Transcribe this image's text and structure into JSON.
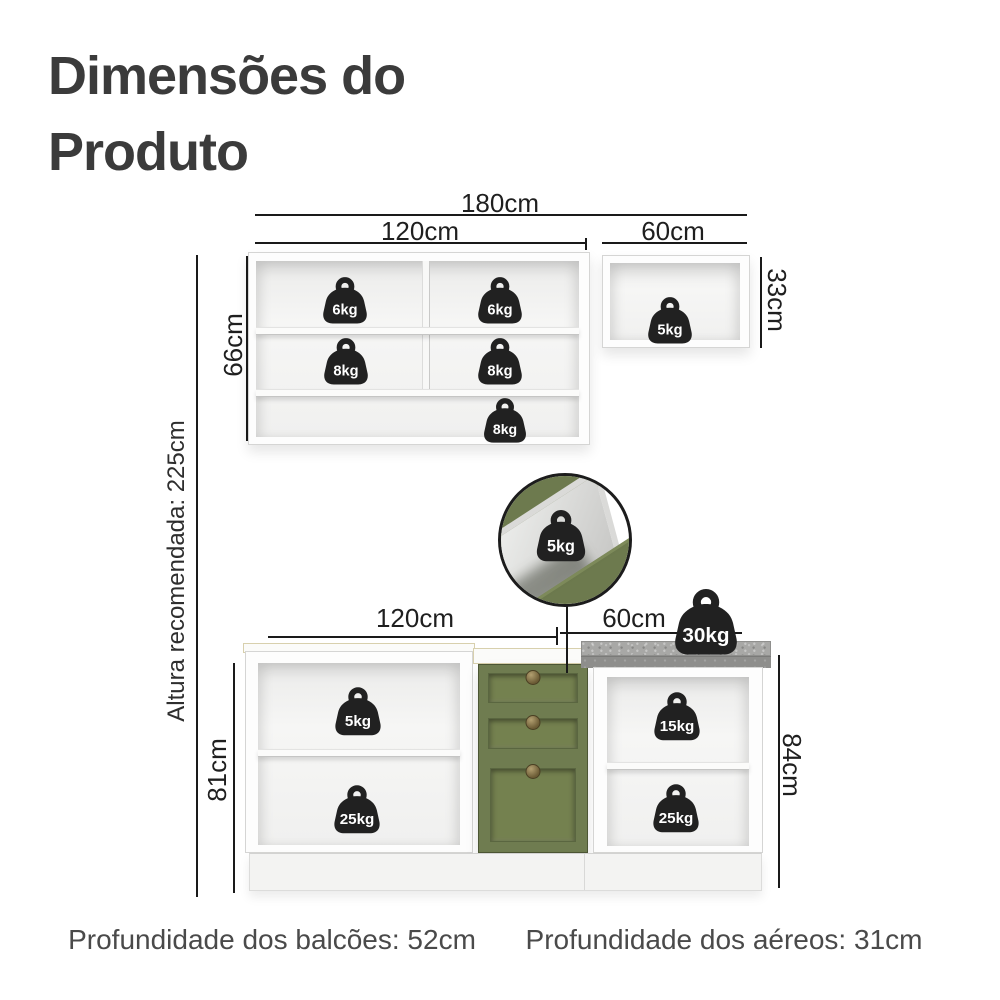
{
  "page": {
    "title": "Dimensões do Produto"
  },
  "colors": {
    "accent_green": "#6F7C50",
    "countertop_gray": "#A8A8A6",
    "badge_black": "#212121",
    "dimension_line": "#1A1A1A",
    "title_text": "#3B3B3B",
    "note_text": "#4A4A4A"
  },
  "dims": {
    "top_total": "180cm",
    "top_left": "120cm",
    "top_right": "60cm",
    "upper_height_left": "66cm",
    "upper_height_right": "33cm",
    "bottom_left": "120cm",
    "bottom_right": "60cm",
    "lower_height_left": "81cm",
    "lower_height_right": "84cm"
  },
  "recommended_height": {
    "label": "Altura recomendada: 225cm"
  },
  "badges": {
    "upper_shelf_top_left": "6kg",
    "upper_shelf_top_right": "6kg",
    "upper_shelf_mid_left": "8kg",
    "upper_shelf_mid_right": "8kg",
    "upper_shelf_bottom": "8kg",
    "upper_right_cabinet": "5kg",
    "callout_drawer": "5kg",
    "countertop": "30kg",
    "lower_left_top": "5kg",
    "lower_left_bottom": "25kg",
    "lower_right_top": "15kg",
    "lower_right_bottom": "25kg"
  },
  "footer": {
    "counters_depth": "Profundidade dos balcões: 52cm",
    "wall_depth": "Profundidade dos aéreos: 31cm"
  }
}
